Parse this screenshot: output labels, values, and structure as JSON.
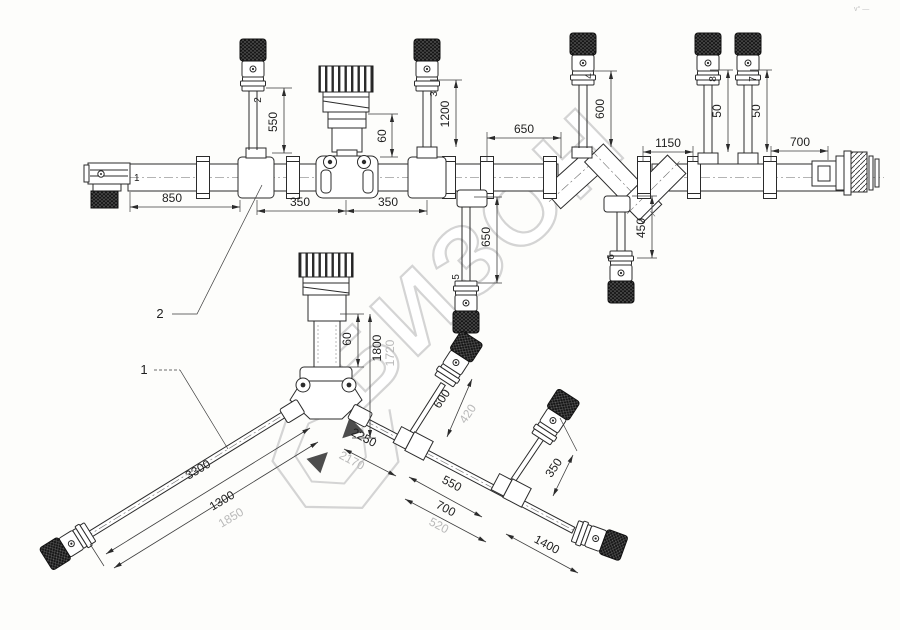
{
  "meta": {
    "corner_mark": "v° —"
  },
  "watermark": {
    "text": "БИЗОН"
  },
  "callouts": {
    "item1": "1",
    "item2": "2"
  },
  "connector_labels": {
    "left_end": "1",
    "b2": "2",
    "b3": "3",
    "b4": "4",
    "b5": "5",
    "b6": "6",
    "b7": "7",
    "b8": "8"
  },
  "dimensions": {
    "top": {
      "d850": "850",
      "d350a": "350",
      "d350b": "350",
      "d550": "550",
      "d60": "60",
      "d1200": "1200",
      "d650_main": "650",
      "d600_b4": "600",
      "d1150": "1150",
      "d50a": "50",
      "d50b": "50",
      "d700": "700",
      "d650_b5": "650",
      "d450": "450"
    },
    "lower": {
      "d60": "60",
      "d1800": "1800",
      "d1800_alt": "1720",
      "d3300": "3300",
      "d1300": "1300",
      "d1300_alt": "1850",
      "d2250": "2250",
      "d2250_alt": "2170",
      "d600": "600",
      "d600_alt": "420",
      "d550": "550",
      "d700": "700",
      "d700_alt": "520",
      "d1400": "1400",
      "d350": "350"
    }
  }
}
